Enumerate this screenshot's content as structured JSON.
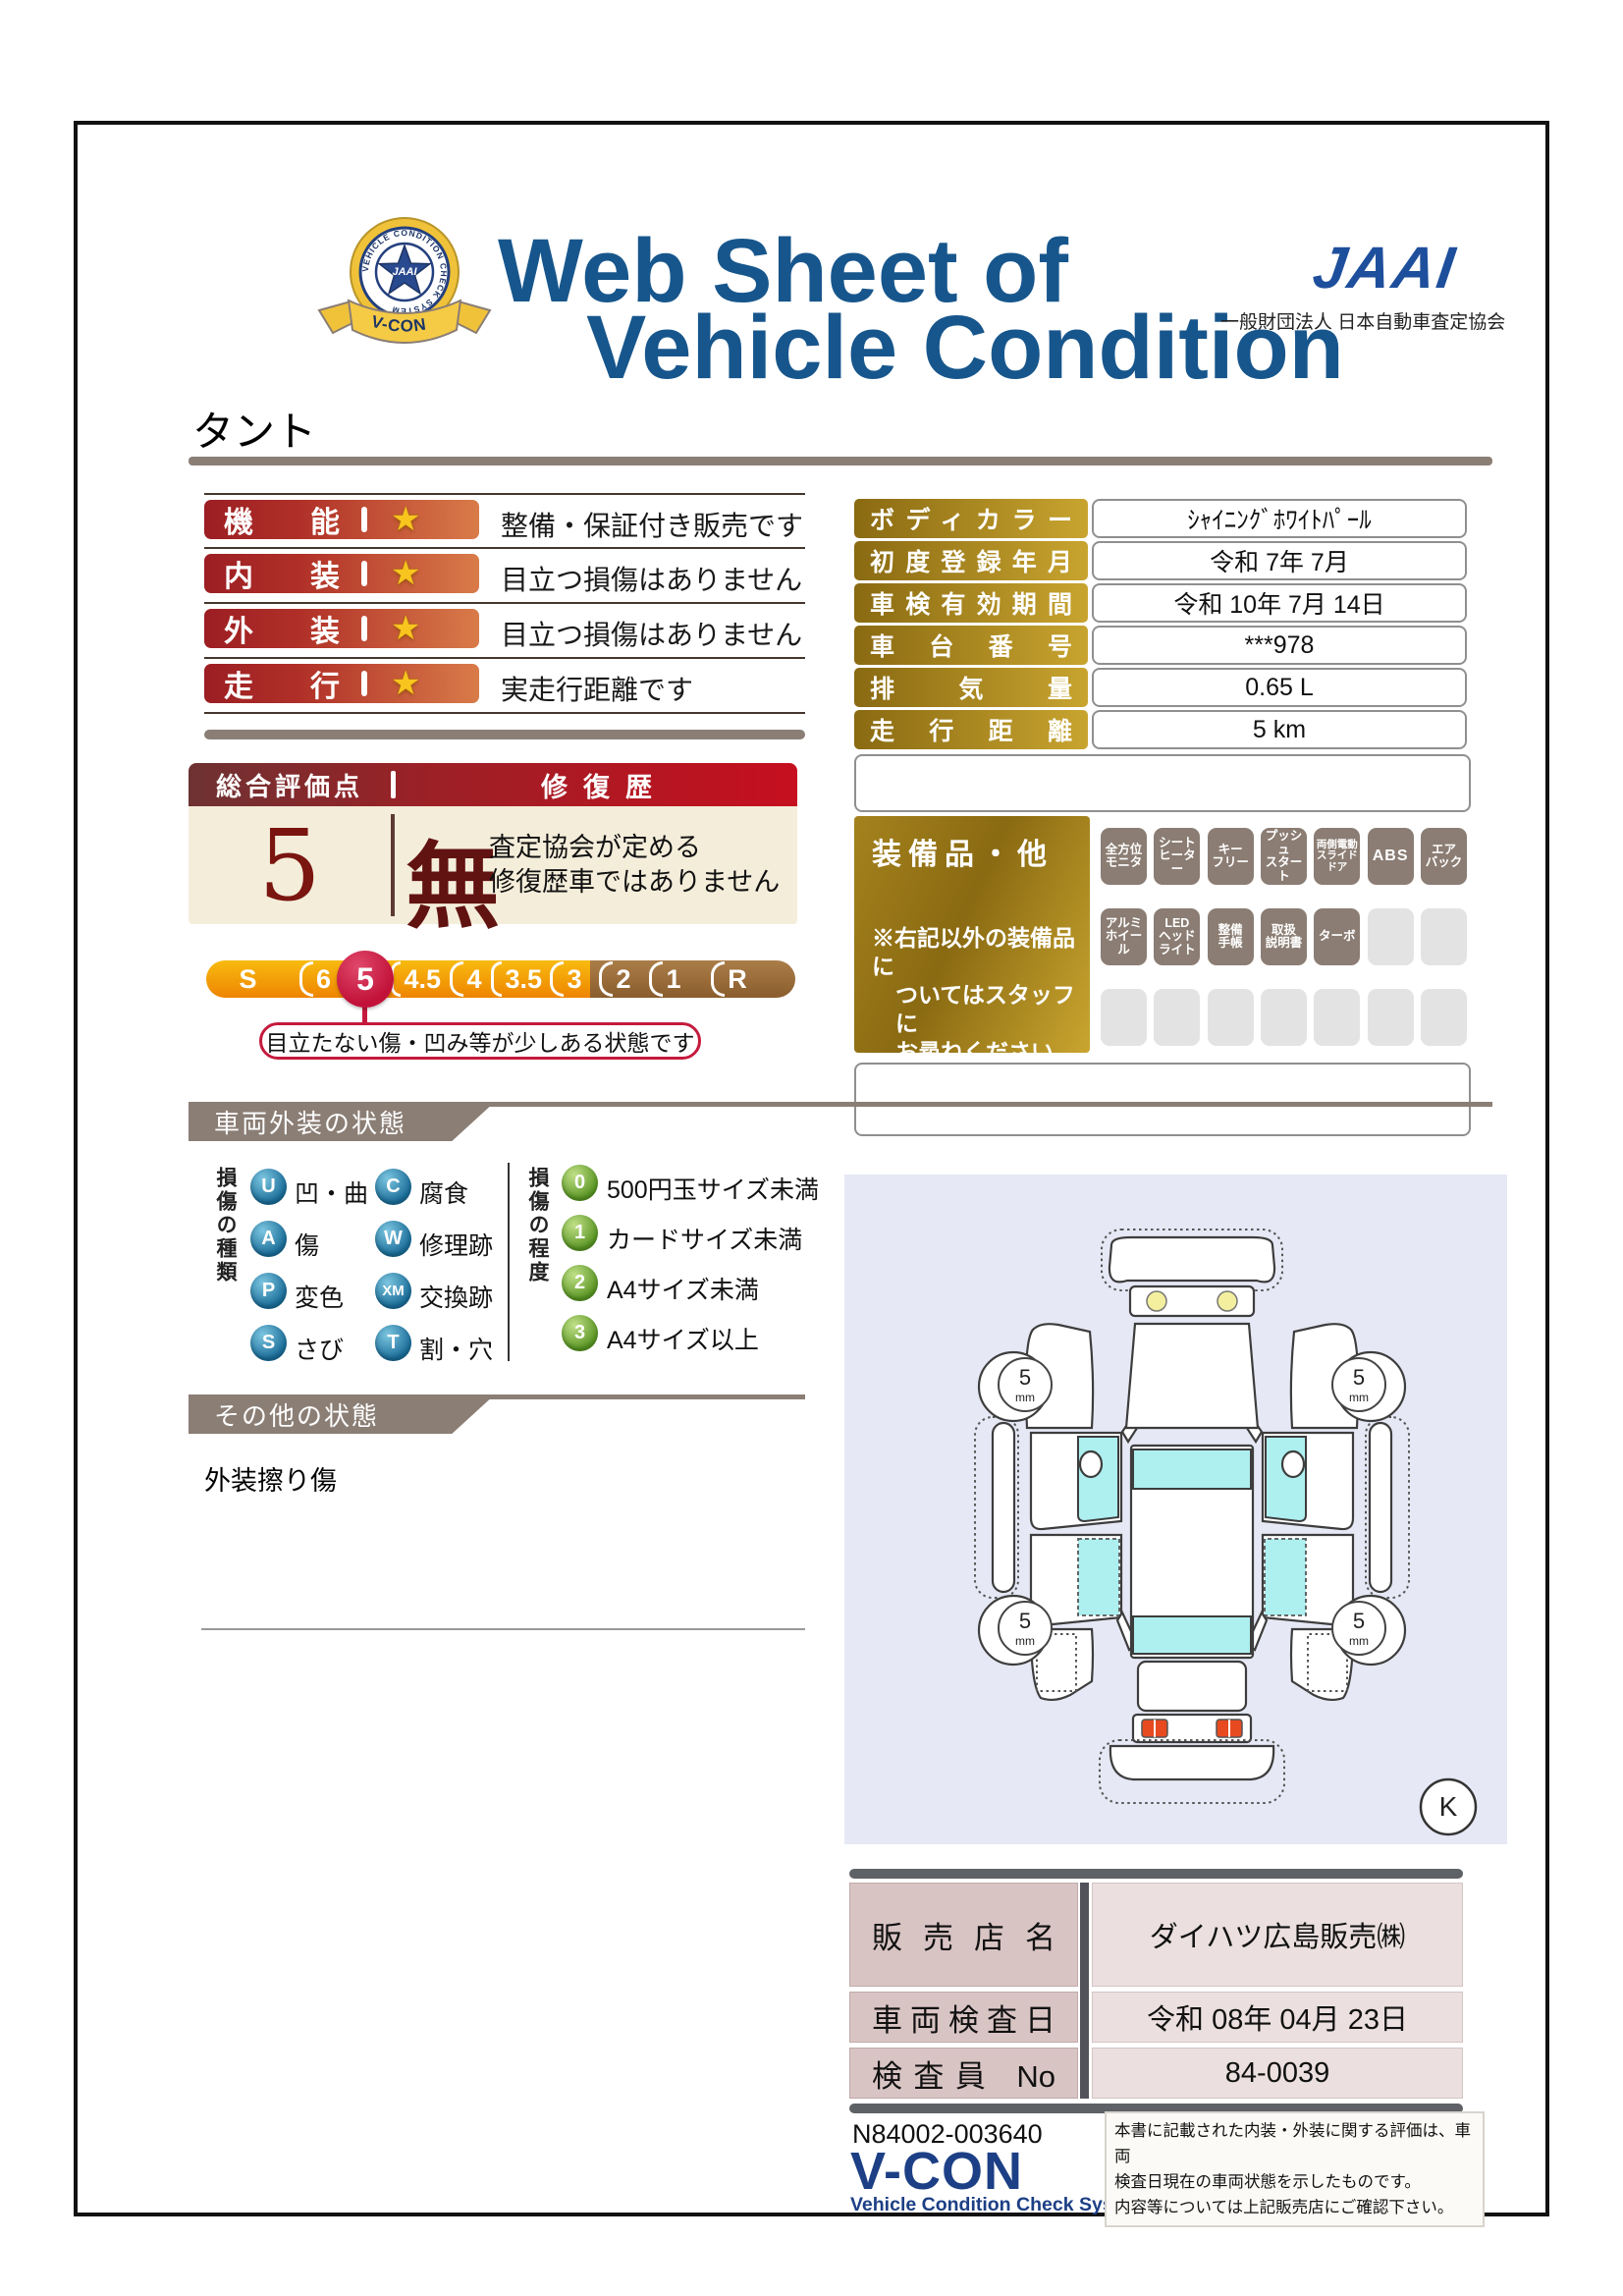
{
  "header": {
    "badge": {
      "ring_text": "VEHICLE CONDITION CHECK SYSTEM",
      "star_text": "JAAI",
      "ribbon_text": "V-CON"
    },
    "title_line1": "Web Sheet of",
    "title_line2": "Vehicle Condition",
    "org_logo": "JAAI",
    "org_name": "一般財団法人 日本自動車査定協会"
  },
  "vehicle_name": "タント",
  "ratings": {
    "star": "★",
    "rows": [
      {
        "label": "機能",
        "comment": "整備・保証付き販売です"
      },
      {
        "label": "内装",
        "comment": "目立つ損傷はありません"
      },
      {
        "label": "外装",
        "comment": "目立つ損傷はありません"
      },
      {
        "label": "走行",
        "comment": "実走行距離です"
      }
    ]
  },
  "info": {
    "rows": [
      {
        "label": "ボディカラー",
        "value": "ｼｬｲﾆﾝｸﾞﾎﾜｲﾄﾊﾟｰﾙ"
      },
      {
        "label": "初度登録年月",
        "value": "令和 7年 7月"
      },
      {
        "label": "車検有効期間",
        "value": "令和 10年 7月 14日"
      },
      {
        "label": "車台番号",
        "value": "***978"
      },
      {
        "label": "排気量",
        "value": "0.65 L"
      },
      {
        "label": "走行距離",
        "value": "5 km"
      }
    ]
  },
  "overall": {
    "title": "総合評価点",
    "repair_title": "修復歴",
    "score": "5",
    "repair_value": "無",
    "repair_note1": "査定協会が定める",
    "repair_note2": "修復歴車ではありません"
  },
  "scale": {
    "segments": [
      "S",
      "6",
      "5",
      "4.5",
      "4",
      "3.5",
      "3",
      "2",
      "1",
      "R"
    ],
    "selected": "5",
    "callout": "目立たない傷・凹み等が少しある状態です"
  },
  "equipment": {
    "title": "装備品・他",
    "note_lines": [
      "※右記以外の装備品に",
      "ついてはスタッフに",
      "お尋ねください。"
    ],
    "badges": [
      {
        "label": "全方位\nモニタ",
        "filled": true
      },
      {
        "label": "シート\nヒーター",
        "filled": true
      },
      {
        "label": "キー\nフリー",
        "filled": true
      },
      {
        "label": "プッシュ\nスタート",
        "filled": true
      },
      {
        "label": "両側電動\nスライド\nドア",
        "filled": true
      },
      {
        "label": "ABS",
        "filled": true
      },
      {
        "label": "エア\nバック",
        "filled": true
      },
      {
        "label": "アルミ\nホイール",
        "filled": true
      },
      {
        "label": "LED\nヘッド\nライト",
        "filled": true
      },
      {
        "label": "整備\n手帳",
        "filled": true
      },
      {
        "label": "取扱\n説明書",
        "filled": true
      },
      {
        "label": "ターボ",
        "filled": true
      },
      {
        "label": "",
        "filled": false
      },
      {
        "label": "",
        "filled": false
      },
      {
        "label": "",
        "filled": false
      },
      {
        "label": "",
        "filled": false
      },
      {
        "label": "",
        "filled": false
      },
      {
        "label": "",
        "filled": false
      },
      {
        "label": "",
        "filled": false
      },
      {
        "label": "",
        "filled": false
      },
      {
        "label": "",
        "filled": false
      }
    ]
  },
  "exterior": {
    "title": "車両外装の状態",
    "types_title": "損傷の種類",
    "types": [
      {
        "code": "U",
        "label": "凹・曲"
      },
      {
        "code": "C",
        "label": "腐食"
      },
      {
        "code": "A",
        "label": "傷"
      },
      {
        "code": "W",
        "label": "修理跡"
      },
      {
        "code": "P",
        "label": "変色"
      },
      {
        "code": "XM",
        "label": "交換跡"
      },
      {
        "code": "S",
        "label": "さび"
      },
      {
        "code": "T",
        "label": "割・穴"
      }
    ],
    "grades_title": "損傷の程度",
    "grades": [
      {
        "code": "0",
        "label": "500円玉サイズ未満"
      },
      {
        "code": "1",
        "label": "カードサイズ未満"
      },
      {
        "code": "2",
        "label": "A4サイズ未満"
      },
      {
        "code": "3",
        "label": "A4サイズ以上"
      }
    ]
  },
  "other": {
    "title": "その他の状態",
    "note": "外装擦り傷"
  },
  "diagram": {
    "tire_value": "5",
    "tire_unit": "mm",
    "corner_label": "K"
  },
  "dealer": {
    "rows": [
      {
        "label": "販売店名",
        "value": "ダイハツ広島販売㈱"
      },
      {
        "label": "車両検査日",
        "value": "令和 08年 04月 23日"
      },
      {
        "label": "検査員 No",
        "value": "84-0039"
      }
    ]
  },
  "footer": {
    "doc_no": "N84002-003640",
    "logo": "V-CON",
    "logo_sub": "Vehicle Condition Check System",
    "disclaimer_lines": [
      "本書に記載された内装・外装に関する評価は、車両",
      "検査日現在の車両状態を示したものです。",
      "内容等については上記販売店にご確認下さい。"
    ]
  }
}
